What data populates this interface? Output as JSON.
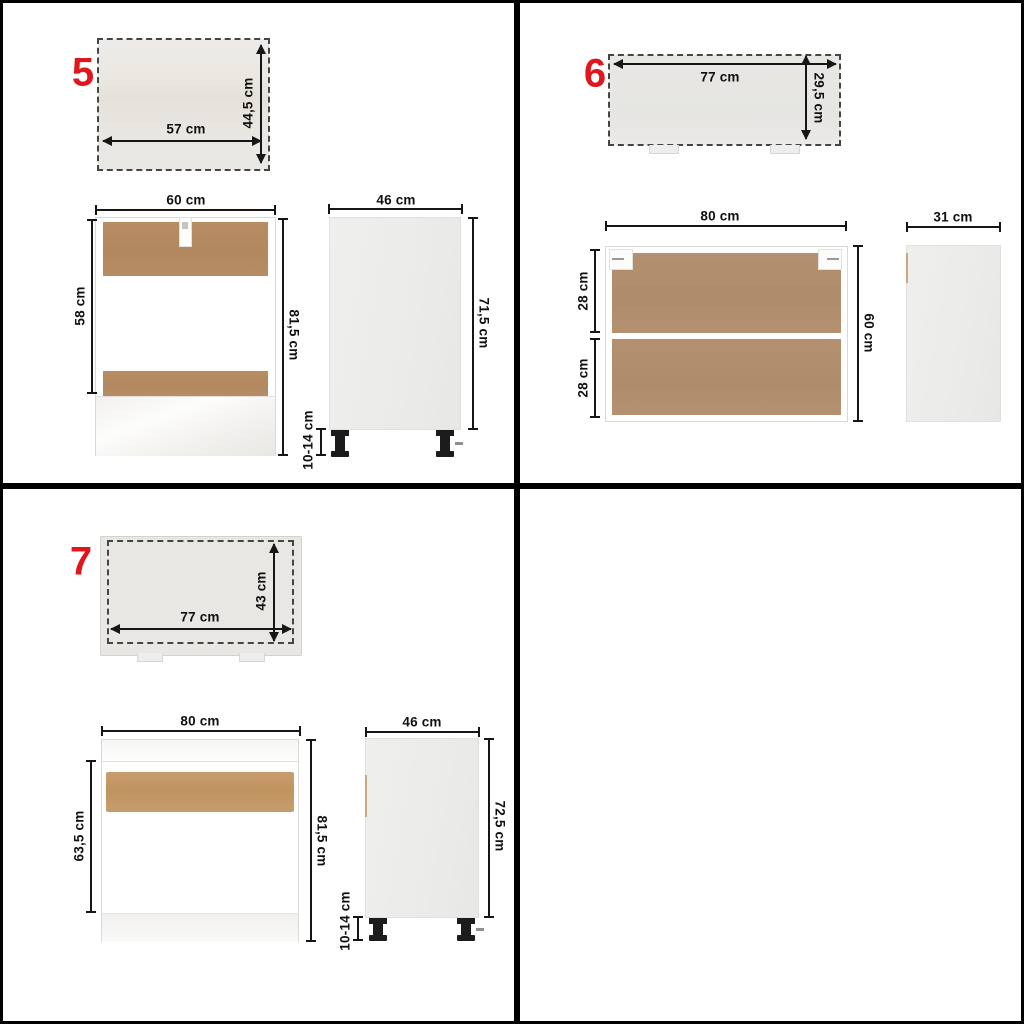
{
  "colors": {
    "accent_red": "#e1151d",
    "divider_black": "#000000",
    "wood_item5": "#b48a62",
    "wood_item6": "#b29070",
    "wood_item7": "#c49a6b",
    "panel_gray": "#e9e7e4"
  },
  "items": {
    "item5": {
      "number": "5",
      "panel": {
        "width": "57 cm",
        "height": "44,5 cm"
      },
      "front": {
        "width": "60 cm",
        "interior_height": "58 cm",
        "total_height": "81,5 cm"
      },
      "side": {
        "depth": "46 cm",
        "height": "71,5 cm",
        "legs": "10-14 cm"
      }
    },
    "item6": {
      "number": "6",
      "panel": {
        "width": "77 cm",
        "height": "29,5 cm"
      },
      "front": {
        "width": "80 cm",
        "upper_section": "28 cm",
        "lower_section": "28 cm",
        "total_height": "60 cm"
      },
      "side": {
        "depth": "31 cm"
      }
    },
    "item7": {
      "number": "7",
      "panel": {
        "width": "77 cm",
        "height": "43 cm"
      },
      "front": {
        "width": "80 cm",
        "interior_height": "63,5 cm",
        "total_height": "81,5 cm"
      },
      "side": {
        "depth": "46 cm",
        "height": "72,5 cm",
        "legs": "10-14 cm"
      }
    }
  }
}
